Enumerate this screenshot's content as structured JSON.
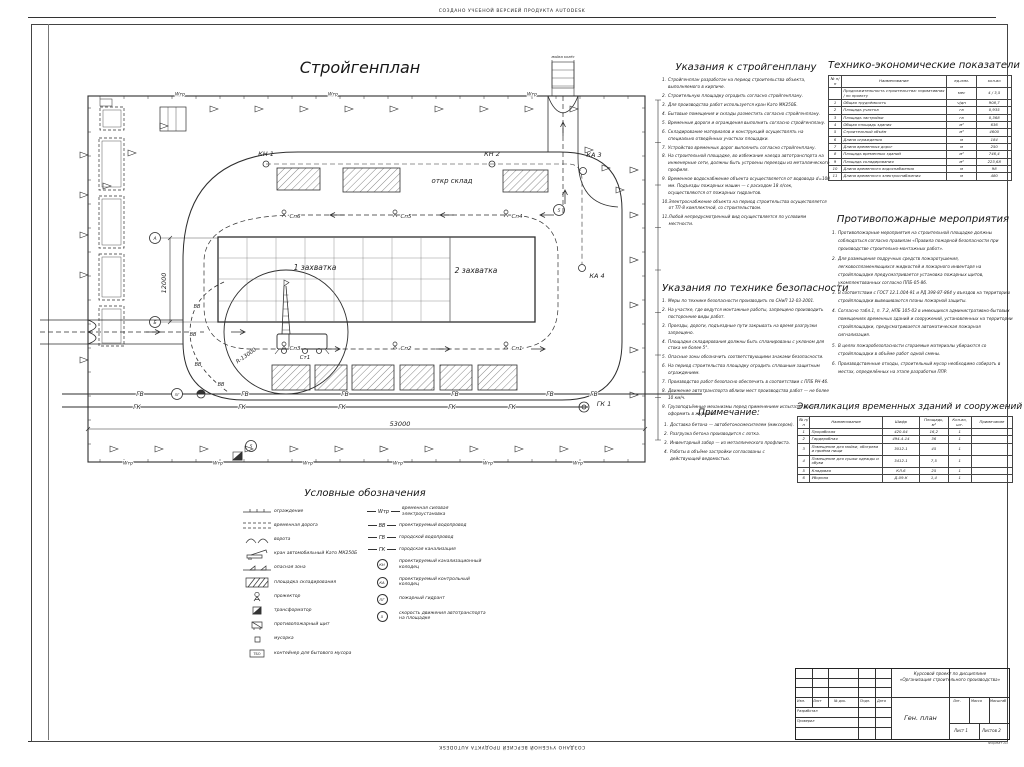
{
  "watermarks": {
    "top": "СОЗДАНО УЧЕБНОЙ ВЕРСИЕЙ ПРОДУКТА AUTODESK",
    "bottom": "СОЗДАНО УЧЕБНОЙ ВЕРСИЕЙ ПРОДУКТА AUTODESK"
  },
  "plan": {
    "title": "Стройгенплан",
    "zone1": "1 захватка",
    "zone2": "2 захватка",
    "open_storage": "откр склад",
    "crane_stand": "Ст1",
    "crane_radius": "R-13000",
    "wash": "мойка колёс",
    "dim_width": "53000",
    "dim_height": "12000",
    "axis_top": "А",
    "axis_bottom": "Б",
    "kn1": "КН 1",
    "kn2": "КН 2",
    "ka3": "КА 3",
    "ka4": "КА 4",
    "gk1": "ГК 1",
    "pg": "ПГ",
    "speed": "5",
    "gv": "ГВ",
    "gk": "ГК",
    "vv": "ВВ",
    "wtr": "Wтр",
    "floodlights_top": [
      "Сп6",
      "Сп5",
      "Сп4"
    ],
    "floodlights_bottom": [
      "Сп3",
      "Сп2",
      "Сп1"
    ]
  },
  "ukazaniya": {
    "title": "Указания к стройгенплану",
    "items": [
      "Стройгенплан разработан на период строительства объекта, выполняемого в кирпиче.",
      "Строительную площадку оградить согласно стройгенплану.",
      "Для производства работ используется кран Като МК250Б.",
      "Бытовые помещения и склады разместить согласно стройгенплану.",
      "Временные дороги и ограждения выполнить согласно стройгенплану.",
      "Складирование материалов и конструкций осуществлять на специально отведённых участках площадки.",
      "Устройство временных дорог выполнить согласно стройгенплану.",
      "На строительной площадке, во избежание наезда автотранспорта на инженерные сети, должны быть устроены переезды из металлического профиля.",
      "Временное водоснабжение объекта осуществляется от водовода d=100 мм. Подъезды пожарных машин — с расходом 18 л/сек, осуществляются от пожарных гидрантов.",
      "Электроснабжение объекта на период строительства осуществляется от ТП-8 комплектной, со строительством.",
      "Любой непредусмотренный вид осуществляется по условиям местности."
    ]
  },
  "tep": {
    "title": "Технико-экономические показатели",
    "columns": [
      "№ п/п",
      "Наименование",
      "ед.изм.",
      "кол-во"
    ],
    "rows": [
      [
        "",
        "Продолжительность строительства: нормативная / по проекту",
        "мес",
        "4 / 3,5"
      ],
      [
        "1",
        "Общая трудоёмкость",
        "ч/дн",
        "908,7"
      ],
      [
        "2",
        "Площадь участка",
        "га",
        "0,935"
      ],
      [
        "3",
        "Площадь застройки",
        "га",
        "0,368"
      ],
      [
        "4",
        "Общая площадь здания",
        "м²",
        "636"
      ],
      [
        "5",
        "Строительный объём",
        "м³",
        "4600"
      ],
      [
        "6",
        "Длина ограждения",
        "м",
        "184"
      ],
      [
        "7",
        "Длина временных дорог",
        "м",
        "250"
      ],
      [
        "8",
        "Площадь временных зданий",
        "м²",
        "746,4"
      ],
      [
        "9",
        "Площадь складирования",
        "м²",
        "223,68"
      ],
      [
        "10",
        "Длина временного водоснабжения",
        "м",
        "98"
      ],
      [
        "11",
        "Длина временного электроснабжения",
        "м",
        "480"
      ]
    ]
  },
  "fire": {
    "title": "Противопожарные мероприятия",
    "items": [
      "Противопожарные мероприятия на строительной площадке должны соблюдаться согласно правилам «Правила пожарной безопасности при производстве строительно-монтажных работ».",
      "Для размещения подручных средств пожаротушения, легковоспламеняющихся жидкостей и пожарного инвентаря на стройплощадке предусматривается установка пожарных щитов, укомплектованных согласно ППБ-05-86.",
      "В соответствии с ГОСТ 12.1.004-91 и РД 398-87-864 у въездов на территорию стройплощадки вывешиваются планы пожарной защиты.",
      "Согласно табл.1, п. 7.2, НПБ 105-03 в имеющихся административно-бытовых помещениях временных зданий и сооружений, установленных на территории стройплощадки, предусматривается автоматическая пожарная сигнализация.",
      "В целях пожаробезопасности сгораемые материалы убираются со стройплощадки в объёме работ одной смены.",
      "Производственные отходы, строительный мусор необходимо собирать в местах, определённых на этапе разработки ППР."
    ]
  },
  "safety": {
    "title": "Указания по технике безопасности",
    "items": [
      "Меры по технике безопасности производить по СНиП 12-03-2001.",
      "На участке, где ведутся монтажные работы, запрещено производить посторонние виды работ.",
      "Проезды, дороги, подъездные пути закрывать на время разгрузки запрещено.",
      "Площадки складирования должны быть спланированы с уклоном для стока не более 5°.",
      "Опасные зоны обозначить соответствующими знаками безопасности.",
      "На период строительства площадку оградить сплошным защитным ограждением.",
      "Производство работ безопасно обеспечить в соответствии с ППБ РН-46.",
      "Движение автотранспорта вблизи мест производства работ — не более 10 км/ч.",
      "Грузоподъёмные механизмы перед применением испытать, допуск оформить в журнале."
    ]
  },
  "notes": {
    "title": "Примечание:",
    "items": [
      "Доставка бетона — автобетоносмесителем (миксером).",
      "Разгрузка бетона производится с лотка.",
      "Инвентарный забор — из металлического профлиста.",
      "Работы в объёме застройки согласованы с действующей ведомостью."
    ]
  },
  "explication": {
    "title": "Экспликация временных зданий и сооружений",
    "columns": [
      "№ п/п",
      "Наименование",
      "Шифр",
      "Площадь, м²",
      "Кол-во, шт.",
      "Примечание"
    ],
    "rows": [
      [
        "1",
        "Прорабская",
        "420-04",
        "16,2",
        "1",
        ""
      ],
      [
        "2",
        "Гардеробная",
        "494-4-14",
        "36",
        "1",
        ""
      ],
      [
        "3",
        "Помещение для мойки, обогрева и приёма пищи",
        "3012-1",
        "45",
        "1",
        ""
      ],
      [
        "4",
        "Помещение для сушки одежды и обуви",
        "3412-1",
        "7,5",
        "1",
        ""
      ],
      [
        "5",
        "Кладовая",
        "КЛ-6",
        "25",
        "1",
        ""
      ],
      [
        "6",
        "Уборная",
        "Д-09-К",
        "1,4",
        "1",
        ""
      ]
    ]
  },
  "legend": {
    "title": "Условные обозначения",
    "container_code": "ТБО",
    "left": [
      {
        "icon": "fence",
        "label": "ограждение"
      },
      {
        "icon": "temp-road",
        "label": "временная дорога"
      },
      {
        "icon": "gates",
        "label": "ворота"
      },
      {
        "icon": "crane",
        "label": "кран автомобильный Като МК250Б"
      },
      {
        "icon": "danger",
        "label": "опасная зона"
      },
      {
        "icon": "storage",
        "label": "площадка складирования"
      },
      {
        "icon": "floodlight",
        "label": "прожектор"
      },
      {
        "icon": "transformer",
        "label": "трансформатор"
      },
      {
        "icon": "fire-shield",
        "label": "противопожарный щит"
      },
      {
        "icon": "urn",
        "label": "мусорка"
      },
      {
        "icon": "container",
        "label": "контейнер для бытового мусора"
      }
    ],
    "right": [
      {
        "code": "Wтр",
        "circled": false,
        "label": "временная силовая электроустановка"
      },
      {
        "code": "ВВ",
        "circled": false,
        "label": "проектируемый водопровод"
      },
      {
        "code": "ГВ",
        "circled": false,
        "label": "городской водопровод"
      },
      {
        "code": "ГК",
        "circled": false,
        "label": "городская канализация"
      },
      {
        "code": "КН",
        "circled": true,
        "label": "проектируемый канализационный колодец"
      },
      {
        "code": "КА",
        "circled": true,
        "label": "проектируемый контрольный колодец"
      },
      {
        "code": "ПГ",
        "circled": true,
        "label": "пожарный гидрант"
      },
      {
        "code": "5",
        "circled": true,
        "label": "скорость движения автотранспорта на площадке"
      }
    ]
  },
  "titleblock": {
    "project_line1": "Курсовой проект по дисциплине",
    "project_line2": "«Организация строительного производства»",
    "doc_title": "Ген. план",
    "header_cells": [
      "Изм.",
      "Лист",
      "№ док.",
      "Подп.",
      "Дата"
    ],
    "sign_rows": [
      "Разработал",
      "Проверил"
    ],
    "lit": "Лит.",
    "massa": "Масса",
    "masshtab": "Масштаб",
    "sheet": "Лист 1",
    "sheets": "Листов 2",
    "format": "Формат А3"
  }
}
